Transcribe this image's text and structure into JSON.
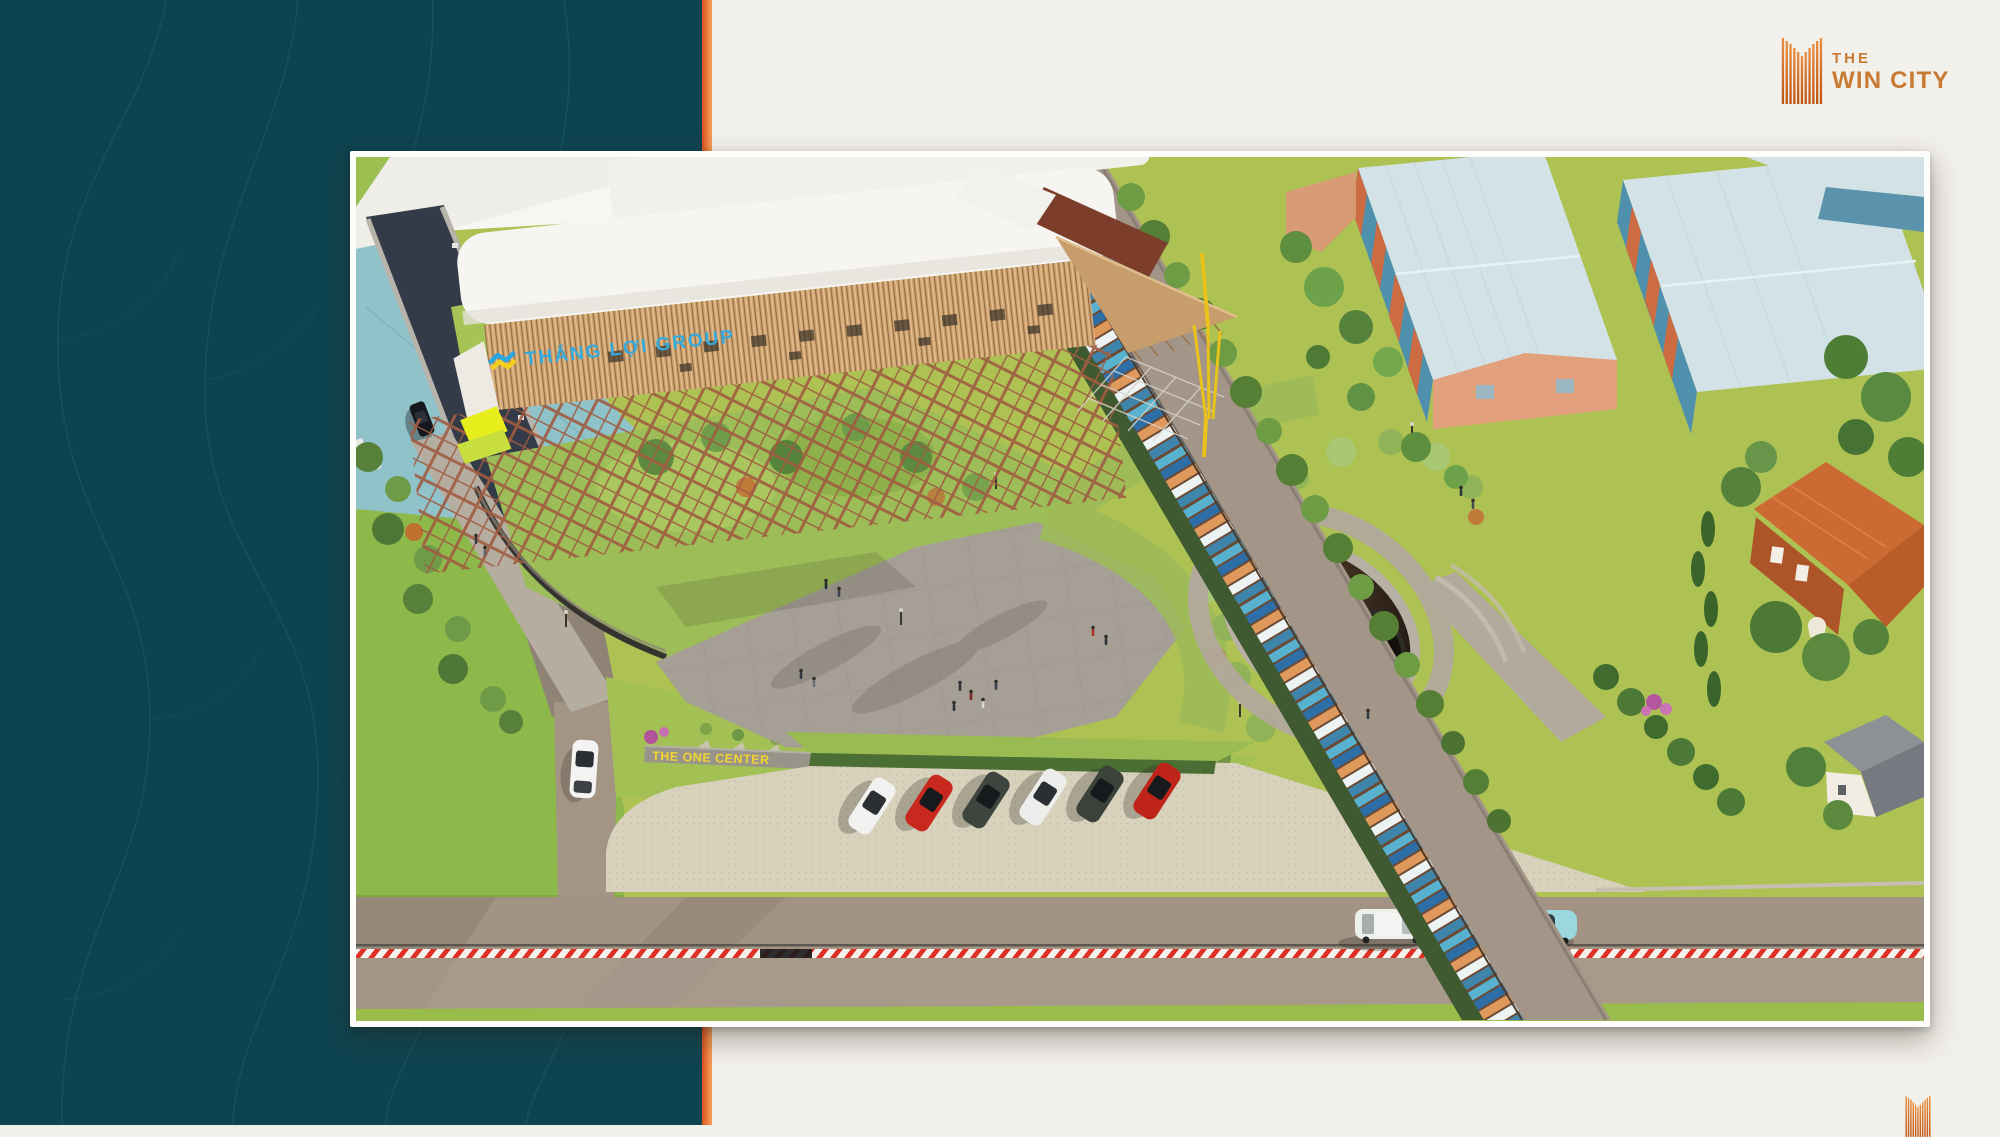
{
  "brand": {
    "line1": "THE",
    "line2": "WIN CITY"
  },
  "photo_labels": {
    "building_sign": "THẮNG LỢI GROUP",
    "center_sign": "THE ONE CENTER",
    "monument_text": "THE WIN"
  },
  "palette": {
    "panel_teal": "#0e4450",
    "panel_line": "#2f7280",
    "stripe_orange_dark": "#dd4f1e",
    "stripe_orange_light": "#f49a55",
    "background_cream": "#f2f0ea",
    "frame_white": "#fdfdfb",
    "logo_orange": "#c87a33",
    "sign_cyan": "#35aade",
    "sign_yellow": "#f2d430",
    "hazard_red": "#df2f23"
  }
}
